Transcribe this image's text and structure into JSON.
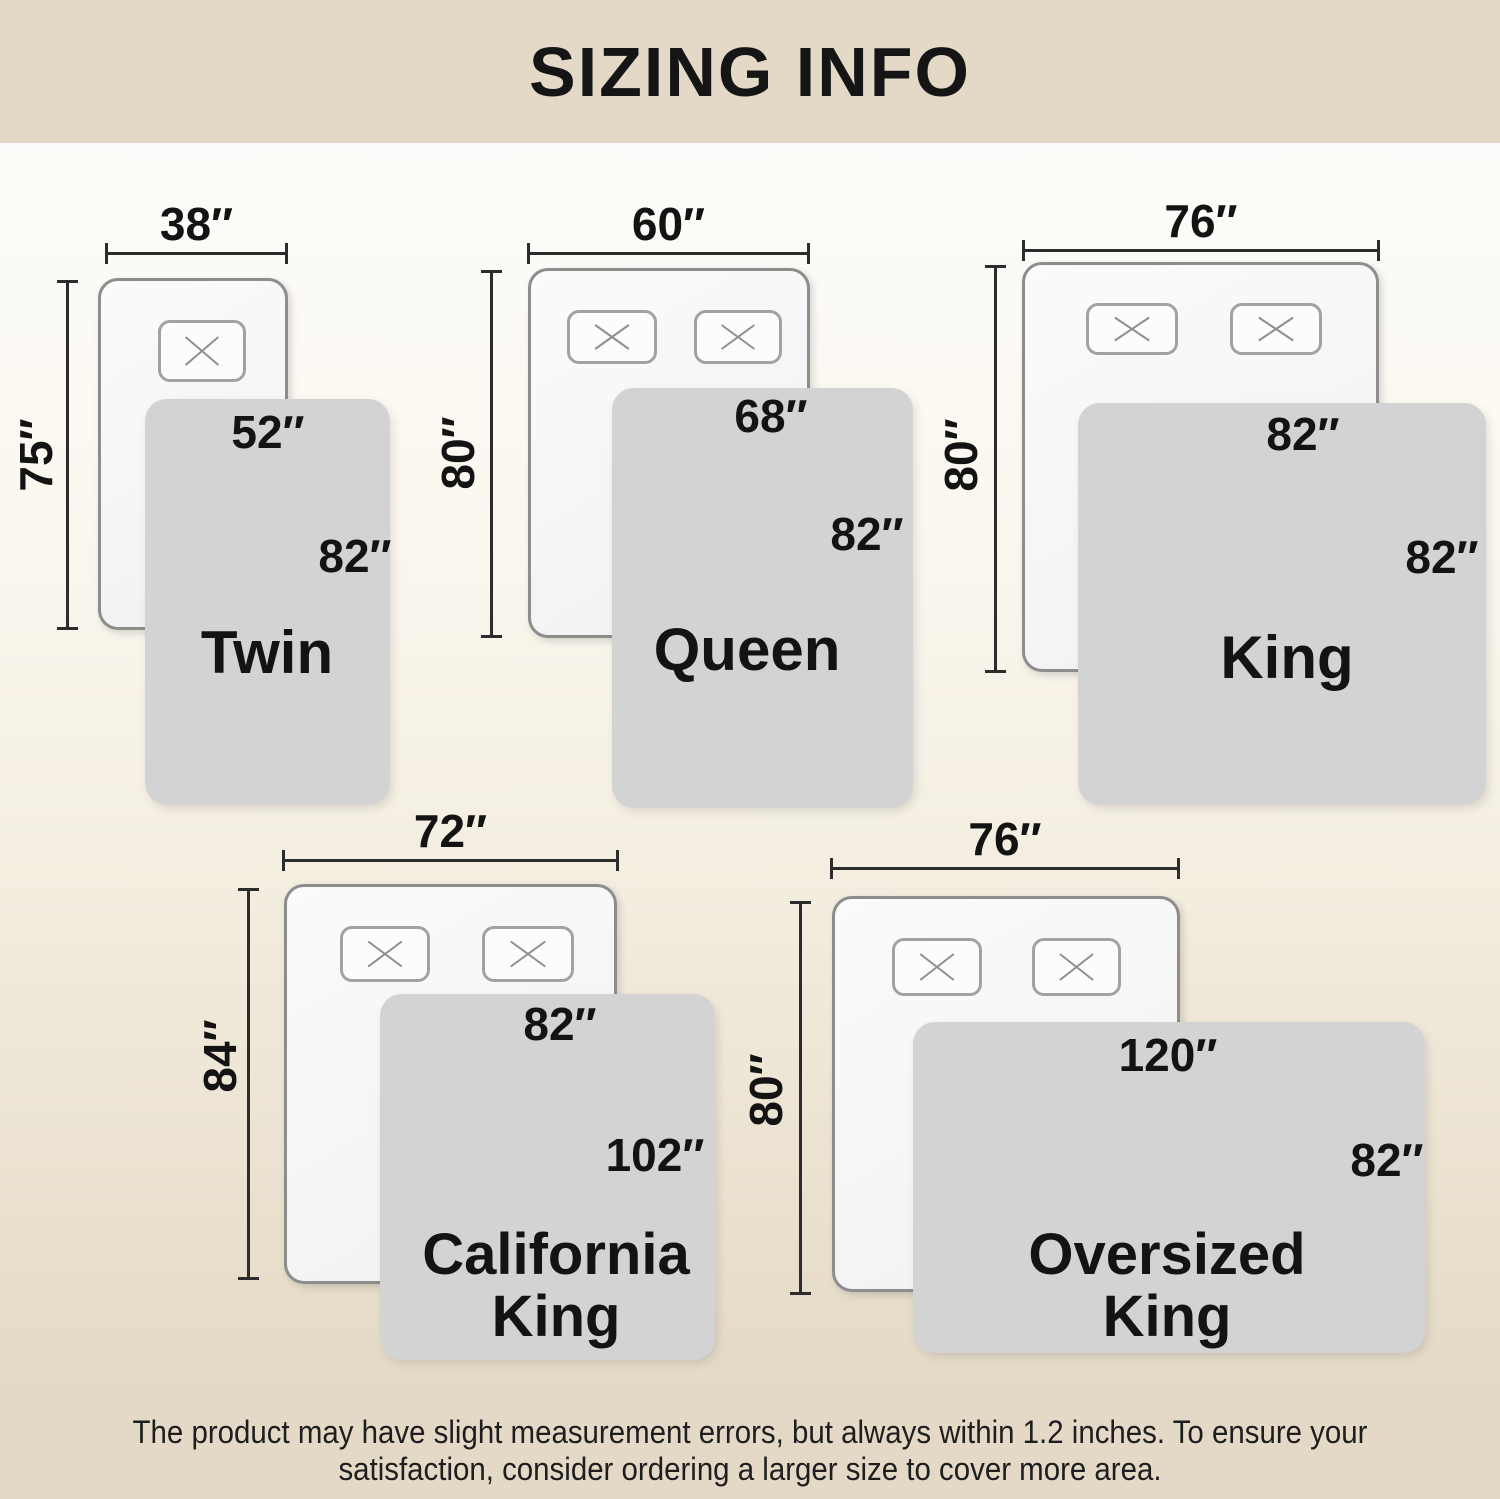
{
  "title": "SIZING INFO",
  "disclaimer": {
    "line1": "The product may have slight measurement errors, but always within 1.2 inches. To ensure your",
    "line2": "satisfaction, consider ordering a larger size to cover more area."
  },
  "colors": {
    "band_bg": "#e4d9c7",
    "page_top_bg": "#fefefe",
    "blanket": "#d3d3d3",
    "bed_fill": "#f6f6f6",
    "bed_border": "#8d8d8d",
    "dimension_line": "#2c2c2c",
    "text": "#131313"
  },
  "sizes": [
    {
      "name": "Twin",
      "bed_width": "38″",
      "bed_length": "75″",
      "blanket_width": "52″",
      "blanket_length": "82″"
    },
    {
      "name": "Queen",
      "bed_width": "60″",
      "bed_length": "80″",
      "blanket_width": "68″",
      "blanket_length": "82″"
    },
    {
      "name": "King",
      "bed_width": "76″",
      "bed_length": "80″",
      "blanket_width": "82″",
      "blanket_length": "82″"
    },
    {
      "name": "California King",
      "name_line1": "California",
      "name_line2": "King",
      "bed_width": "72″",
      "bed_length": "84″",
      "blanket_width": "82″",
      "blanket_length": "102″"
    },
    {
      "name": "Oversized King",
      "name_line1": "Oversized",
      "name_line2": "King",
      "bed_width": "76″",
      "bed_length": "80″",
      "blanket_width": "120″",
      "blanket_length": "82″"
    }
  ]
}
